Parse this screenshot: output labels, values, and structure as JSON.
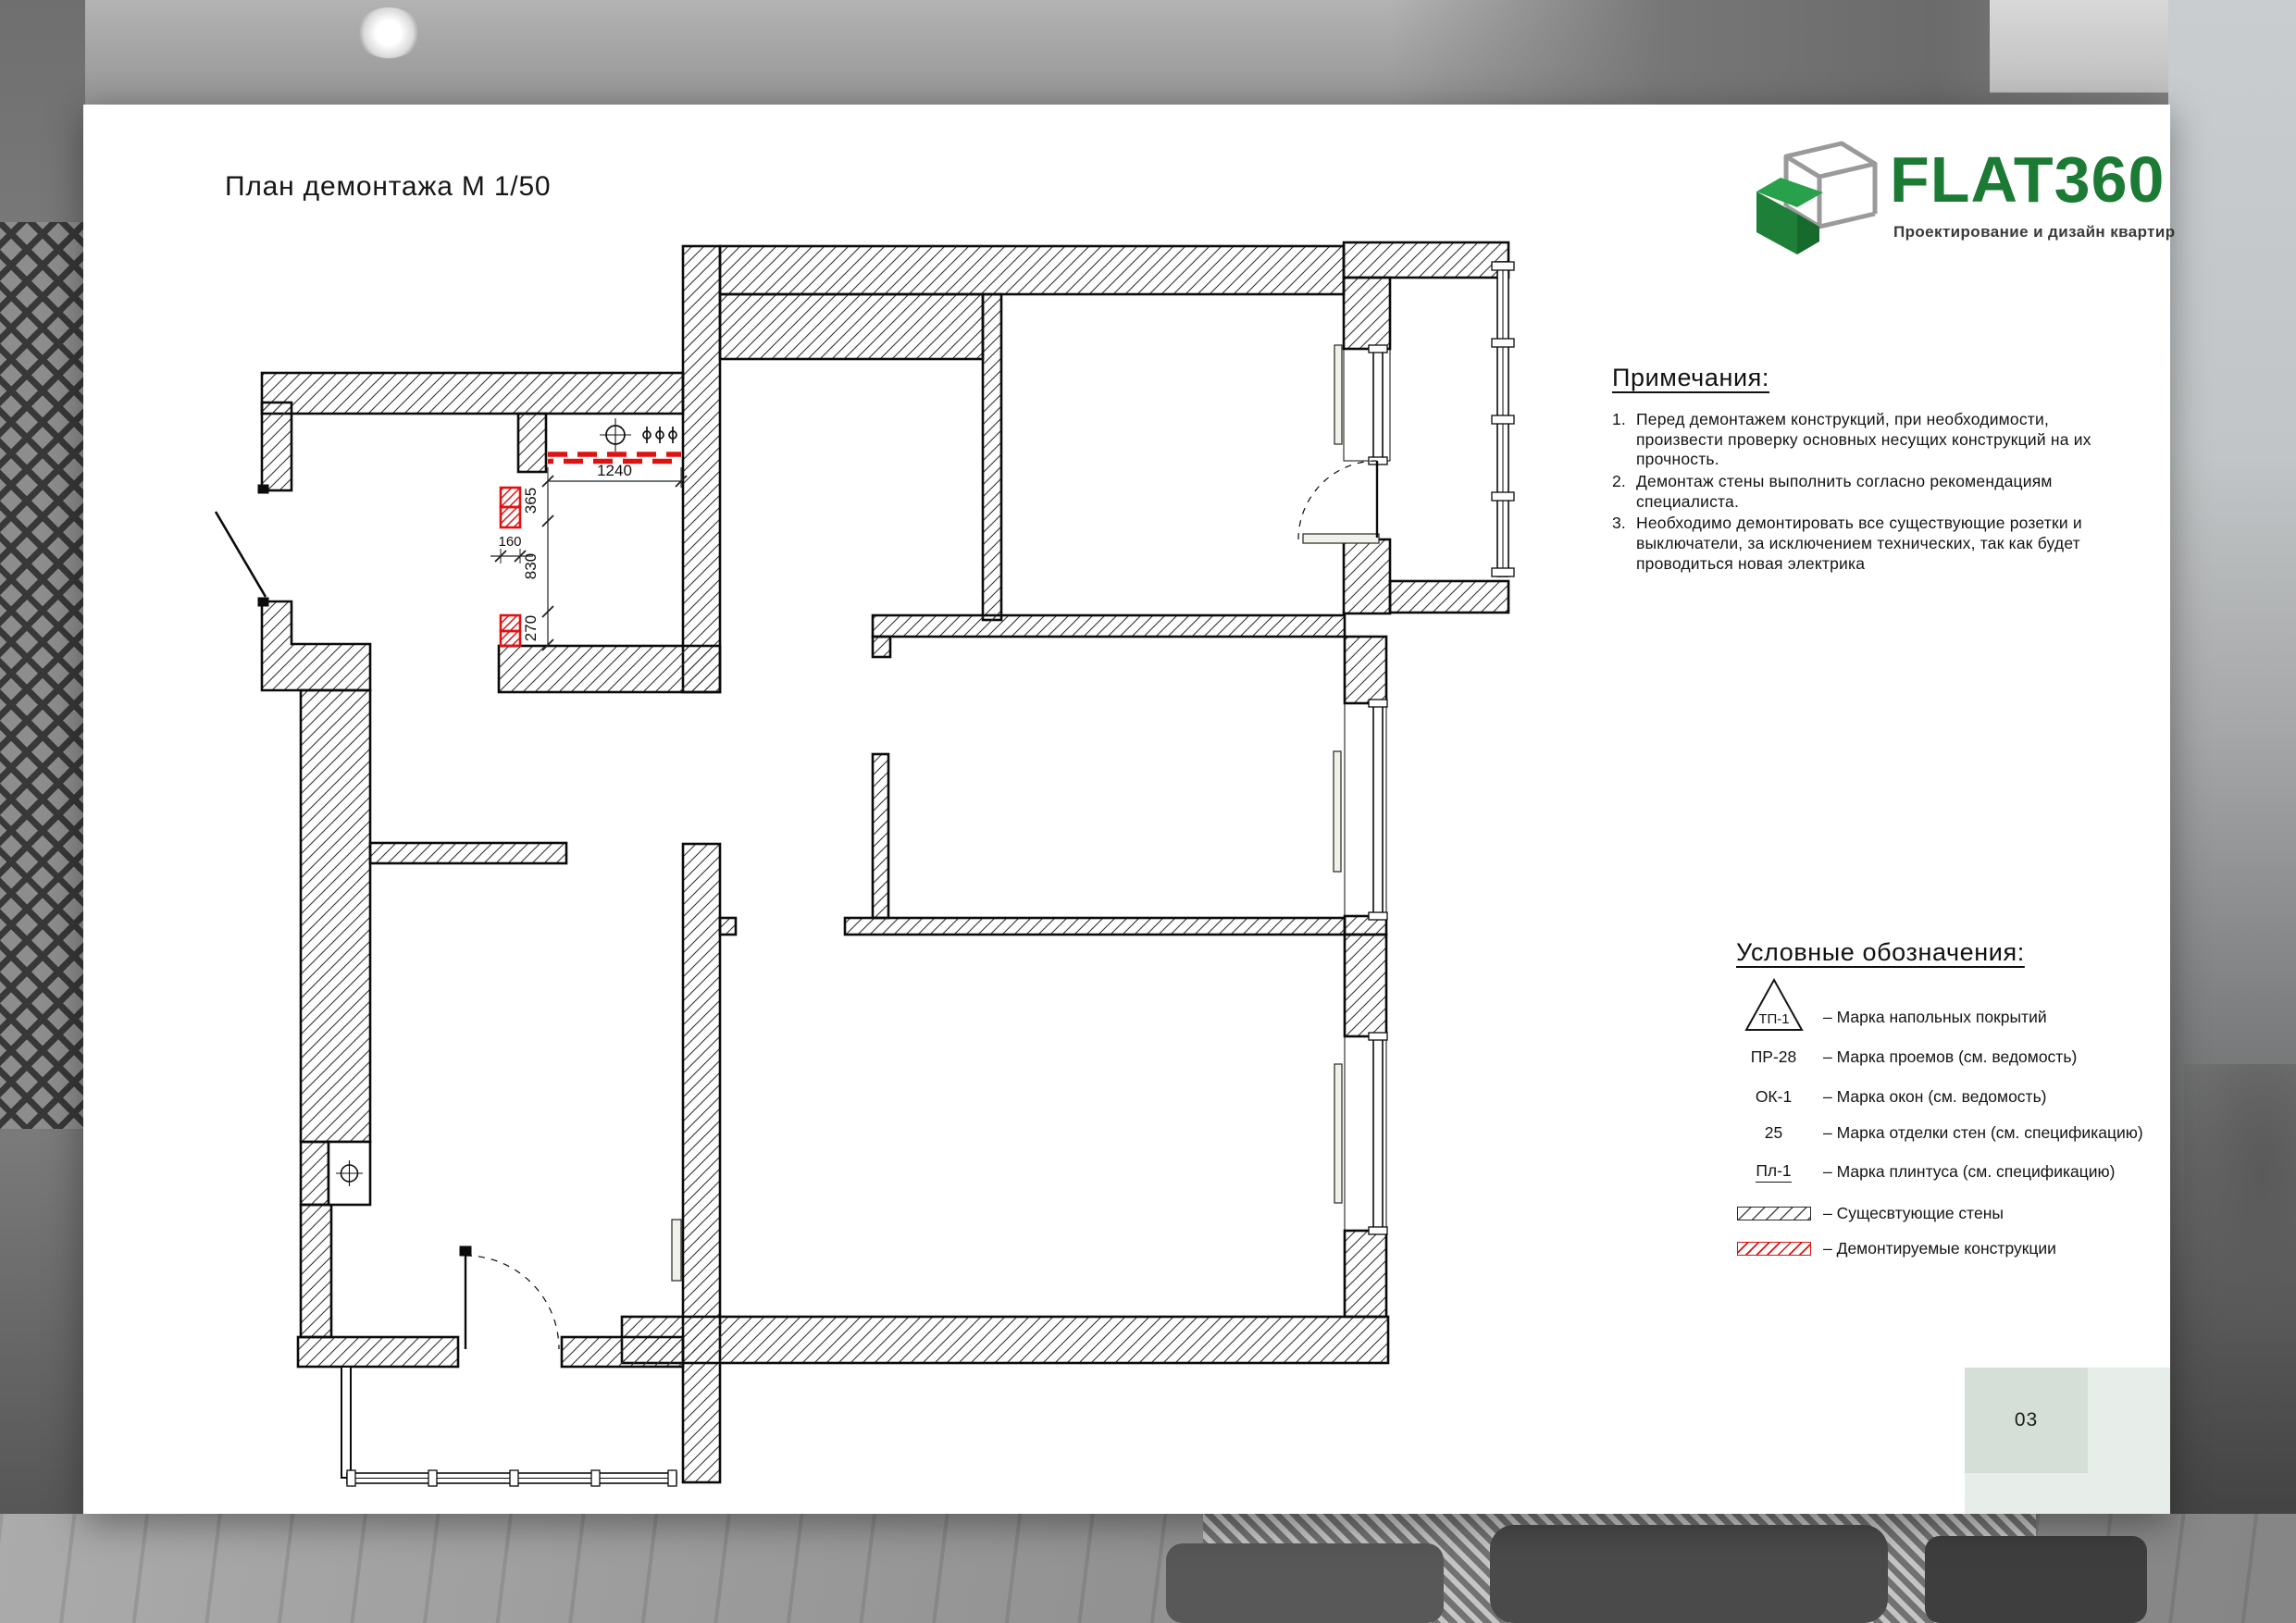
{
  "page": {
    "title": "План демонтажа М 1/50",
    "number": "03"
  },
  "logo": {
    "brand": "FLAT360",
    "tagline": "Проектирование и дизайн квартир",
    "brand_color": "#1b7a33"
  },
  "notes": {
    "heading": "Примечания:",
    "items": [
      {
        "num": "1.",
        "text": "Перед демонтажем конструкций, при необходимости, произвести проверку основных несущих конструкций на их прочность."
      },
      {
        "num": "2.",
        "text": "Демонтаж стены выполнить согласно рекомендациям специалиста."
      },
      {
        "num": "3.",
        "text": "Необходимо демонтировать все существующие розетки и выключатели, за исключением технических, так как будет проводиться новая электрика"
      }
    ]
  },
  "legend": {
    "heading": "Условные обозначения:",
    "marks": [
      {
        "code": "ТП-1",
        "label": "– Марка напольных покрытий"
      },
      {
        "code": "ПР-28",
        "label": "– Марка проемов (см. ведомость)"
      },
      {
        "code": "ОК-1",
        "label": "– Марка окон (см. ведомость)"
      },
      {
        "code": "25",
        "label": "– Марка отделки стен (см. спецификацию)"
      },
      {
        "code": "Пл-1",
        "label": "– Марка плинтуса (см. спецификацию)"
      }
    ],
    "swatches": [
      {
        "type": "existing",
        "label": "– Сущесвтующие стены"
      },
      {
        "type": "demolition",
        "label": "– Демонтируемые конструкции"
      }
    ]
  },
  "plan": {
    "scale_label": "М 1/50",
    "dims": {
      "d1240": "1240",
      "d365": "365",
      "d830": "830",
      "d270": "270",
      "d160": "160"
    },
    "colors": {
      "demolition": "#df1212",
      "wall_stroke": "#0b0b0b"
    }
  }
}
